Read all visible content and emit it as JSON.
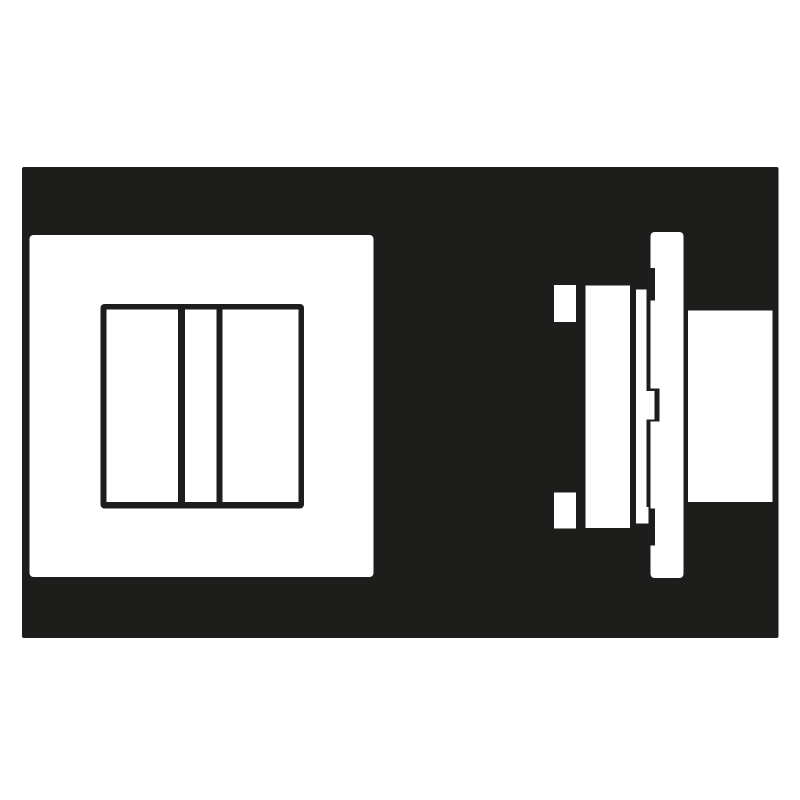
{
  "page": {
    "background_color": "#ffffff"
  },
  "illustration": {
    "name": "flush-mounted two-gang switch pictogram, front view and side profile",
    "colors": {
      "ink": "#1d1d1b",
      "paper": "#ffffff"
    },
    "front_view": {
      "label": "switch-front-view",
      "parts": [
        "cover-plate",
        "frame-opening",
        "rocker-left",
        "center-module",
        "rocker-right"
      ]
    },
    "side_view": {
      "label": "switch-side-profile-view",
      "parts": [
        "mounting-claw-top",
        "mounting-claw-bottom",
        "mechanism-body",
        "support-frame-with-clip",
        "cover-plate-profile",
        "wall-flange"
      ]
    }
  }
}
